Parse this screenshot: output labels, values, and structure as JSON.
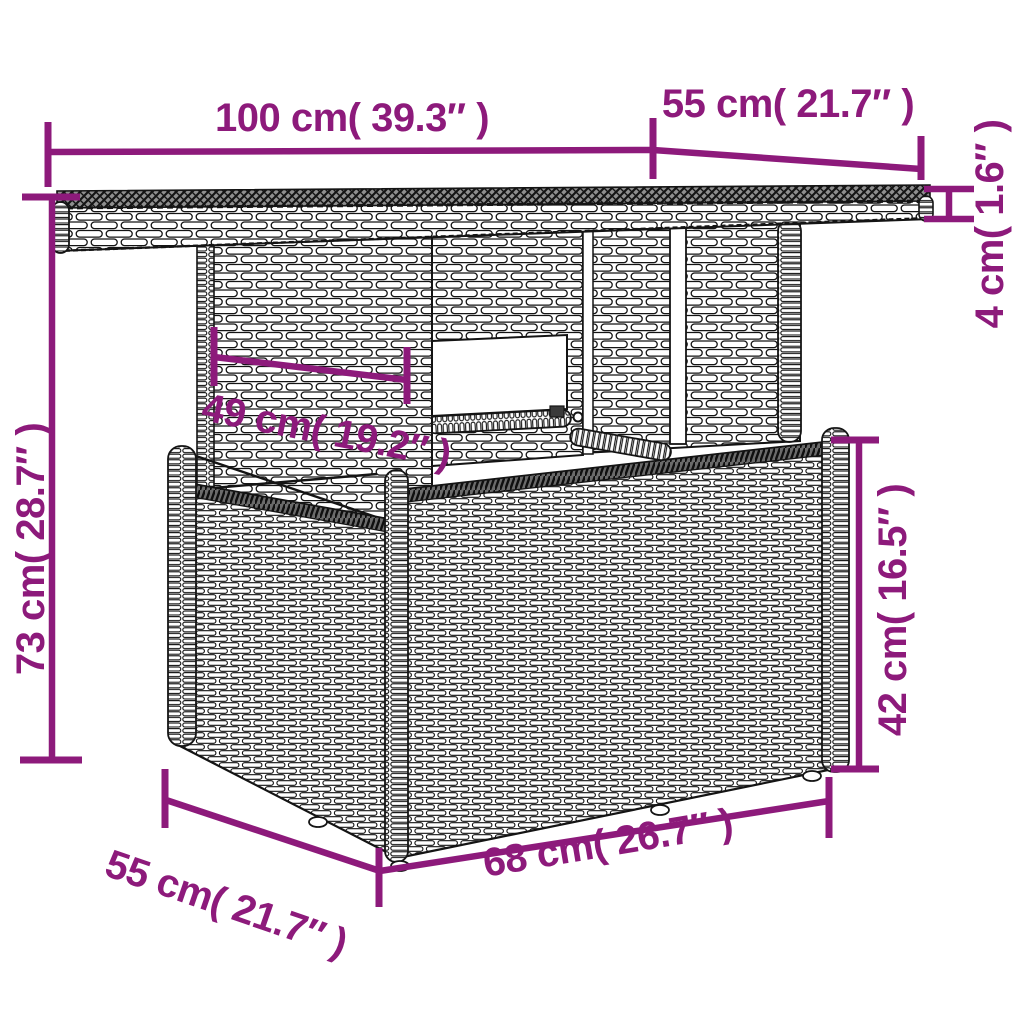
{
  "theme": {
    "background": "#ffffff",
    "accent": "#8d1a7b",
    "line_ink": "#141414",
    "tabletop_surface": "#8f8f8f"
  },
  "illustration": {
    "subject": "rattan-garden-table-with-box-base"
  },
  "dimensions": {
    "top_width": {
      "label": "100 cm( 39.3″ )"
    },
    "top_depth": {
      "label": "55 cm( 21.7″ )"
    },
    "top_thickness": {
      "label": "4 cm( 1.6″ )"
    },
    "total_height": {
      "label": "73 cm( 28.7″ )"
    },
    "panel_width": {
      "label": "49 cm( 19.2″ )"
    },
    "base_height": {
      "label": "42 cm( 16.5″ )"
    },
    "base_depth": {
      "label": "55 cm( 21.7″ )"
    },
    "base_width": {
      "label": "68 cm( 26.7″ )"
    }
  }
}
